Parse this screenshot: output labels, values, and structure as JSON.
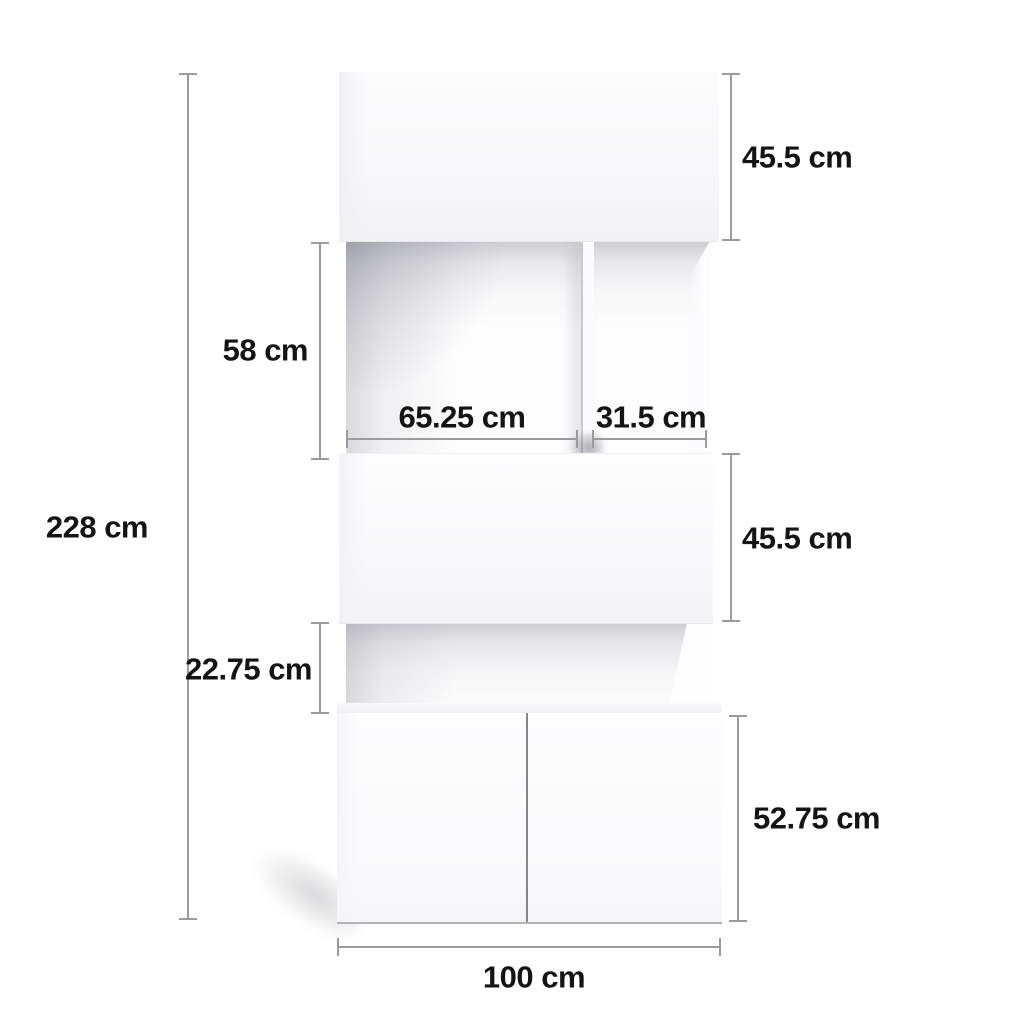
{
  "diagram": {
    "type": "furniture-dimension-diagram",
    "object": "white wall storage unit with open shelves and base cabinet",
    "unit": "cm",
    "labels": {
      "total_height": "228 cm",
      "top_cabinet_height": "45.5 cm",
      "open_shelf_height": "58 cm",
      "left_opening_width": "65.25 cm",
      "right_opening_width": "31.5 cm",
      "middle_cabinet_height": "45.5 cm",
      "lower_opening_height": "22.75 cm",
      "base_cabinet_height": "52.75 cm",
      "total_width": "100 cm"
    },
    "colors": {
      "background": "#ffffff",
      "dimension_line": "#9b9b9b",
      "label_text": "#141414",
      "furniture_face": "#f9f9fb",
      "recess_shadow": "#7d7d8a",
      "door_seam": "#85858a"
    }
  }
}
